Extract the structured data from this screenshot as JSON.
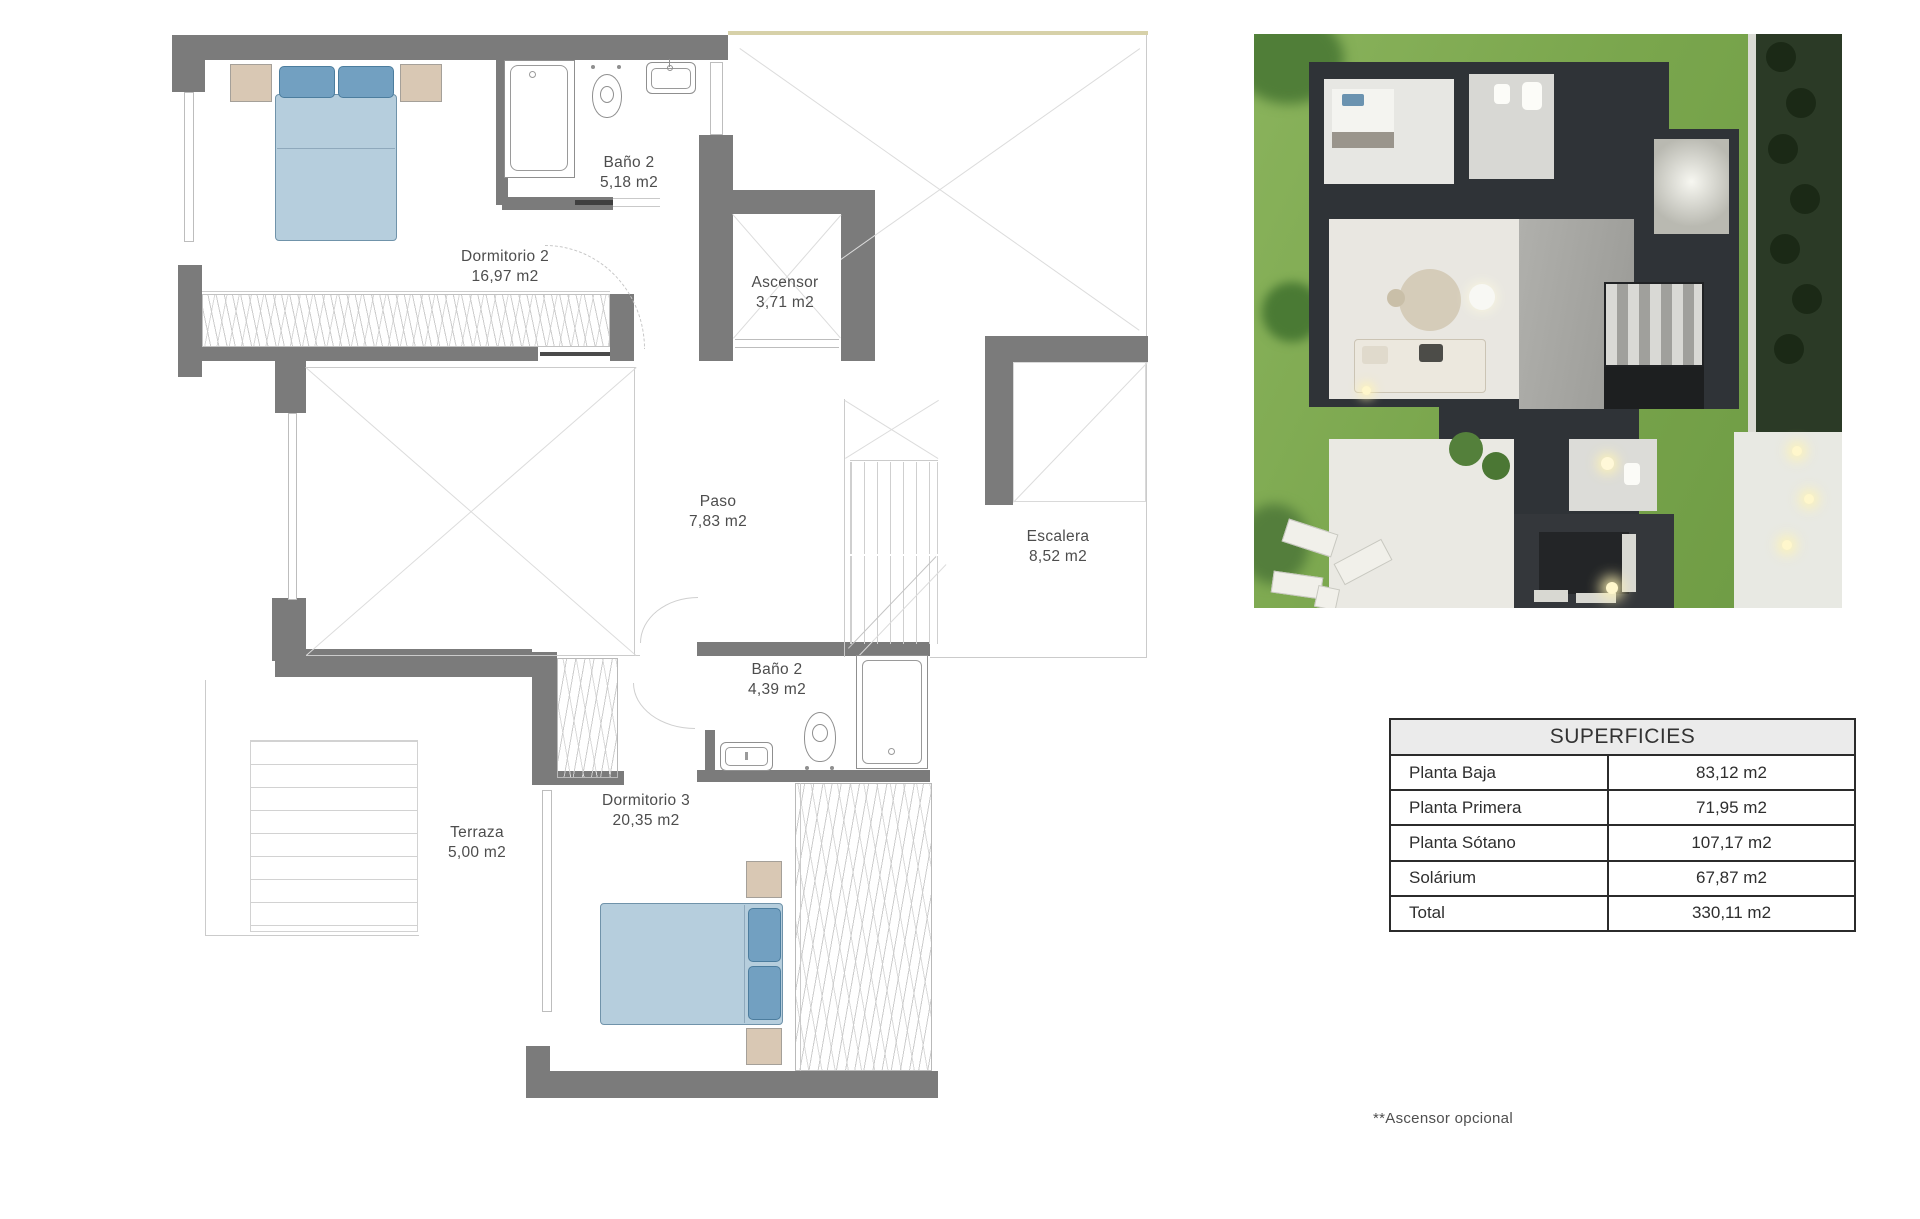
{
  "plan": {
    "rooms": [
      {
        "name": "Dormitorio 2",
        "area": "16,97 m2"
      },
      {
        "name": "Baño 2",
        "area": "5,18 m2"
      },
      {
        "name": "Ascensor",
        "area": "3,71 m2"
      },
      {
        "name": "Paso",
        "area": "7,83 m2"
      },
      {
        "name": "Escalera",
        "area": "8,52 m2"
      },
      {
        "name": "Baño 2",
        "area": "4,39 m2"
      },
      {
        "name": "Terraza",
        "area": "5,00 m2"
      },
      {
        "name": "Dormitorio 3",
        "area": "20,35 m2"
      }
    ]
  },
  "table": {
    "title": "SUPERFICIES",
    "rows": [
      {
        "label": "Planta Baja",
        "value": "83,12 m2"
      },
      {
        "label": "Planta Primera",
        "value": "71,95 m2"
      },
      {
        "label": "Planta Sótano",
        "value": "107,17 m2"
      },
      {
        "label": "Solárium",
        "value": "67,87 m2"
      },
      {
        "label": "Total",
        "value": "330,11 m2"
      }
    ]
  },
  "footnote": "**Ascensor opcional",
  "colors": {
    "wall": "#7b7b7b",
    "bed": "#b6cedd",
    "pillow": "#72a0c1",
    "nightstand": "#d9c8b4",
    "roof_line": "#d7d1a9"
  }
}
